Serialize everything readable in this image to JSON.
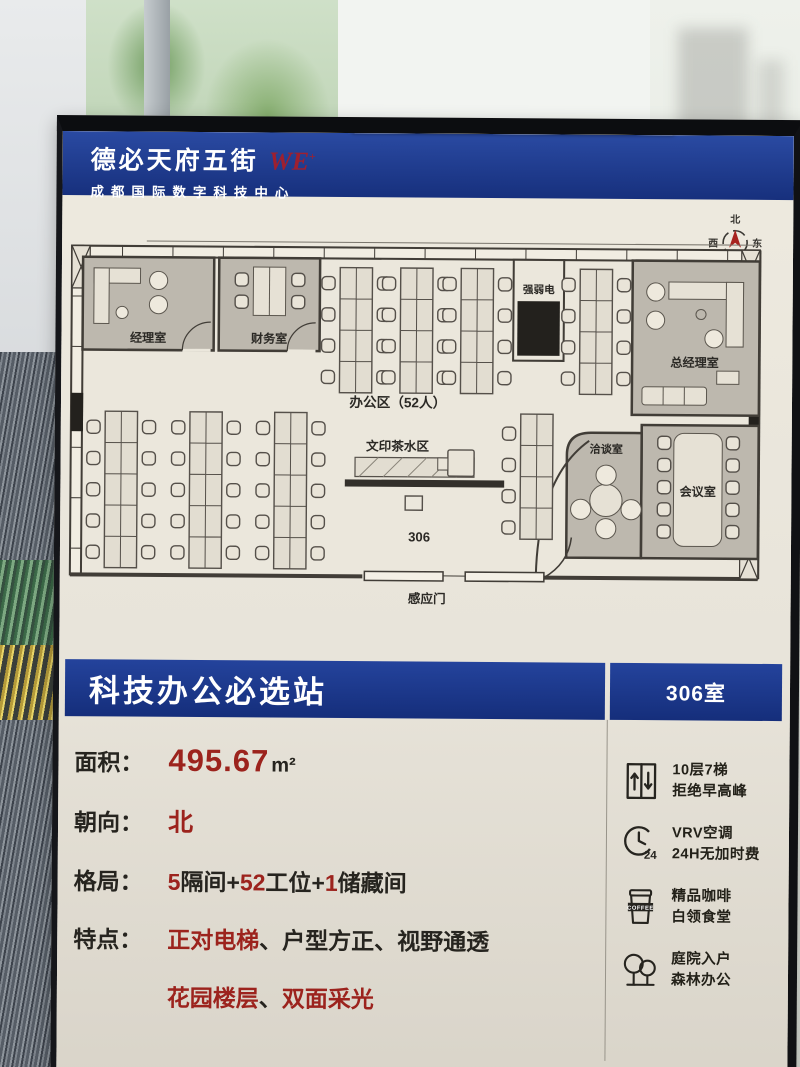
{
  "colors": {
    "blue": "#1c3a8e",
    "red": "#9c231d",
    "ink": "#26241f",
    "cream": "#e9e5db"
  },
  "header": {
    "brand": "德必天府五街",
    "logo": "WE",
    "logo_mark": "+",
    "subtitle": "成都国际数字科技中心"
  },
  "compass": {
    "n": "北",
    "e": "东",
    "s": "南",
    "w": "西"
  },
  "floorplan": {
    "manager_room": "经理室",
    "finance_room": "财务室",
    "utility_room": "强弱电",
    "gm_room": "总经理室",
    "meeting_room": "会议室",
    "talk_room": "洽谈室",
    "office_area": "办公区（52人）",
    "print_tea_area": "文印茶水区",
    "room_number": "306",
    "sensor_door": "感应门"
  },
  "banner": {
    "title": "科技办公必选站",
    "room": "306室"
  },
  "details": {
    "area_label": "面积：",
    "area_value": "495.67",
    "area_unit": "m²",
    "facing_label": "朝向：",
    "facing_value": "北",
    "layout_label": "格局：",
    "layout_segments": [
      {
        "t": "5",
        "c": "r"
      },
      {
        "t": "隔间+",
        "c": "k"
      },
      {
        "t": "52",
        "c": "r"
      },
      {
        "t": "工位+",
        "c": "k"
      },
      {
        "t": "1",
        "c": "r"
      },
      {
        "t": "储藏间",
        "c": "k"
      }
    ],
    "features_label": "特点：",
    "features_line1": [
      {
        "t": "正对电梯",
        "c": "r"
      },
      {
        "t": "、",
        "c": "k"
      },
      {
        "t": "户型方正",
        "c": "k"
      },
      {
        "t": "、",
        "c": "k"
      },
      {
        "t": "视野通透",
        "c": "k"
      }
    ],
    "features_line2": [
      {
        "t": "花园楼层",
        "c": "r"
      },
      {
        "t": "、",
        "c": "k"
      },
      {
        "t": "双面采光",
        "c": "r"
      }
    ]
  },
  "amenities": [
    {
      "line1": "10层7梯",
      "line2": "拒绝早高峰"
    },
    {
      "line1": "VRV空调",
      "line2": "24H无加时费",
      "badge": "24"
    },
    {
      "line1": "精品咖啡",
      "line2": "白领食堂",
      "badge": "COFFEE"
    },
    {
      "line1": "庭院入户",
      "line2": "森林办公"
    }
  ]
}
